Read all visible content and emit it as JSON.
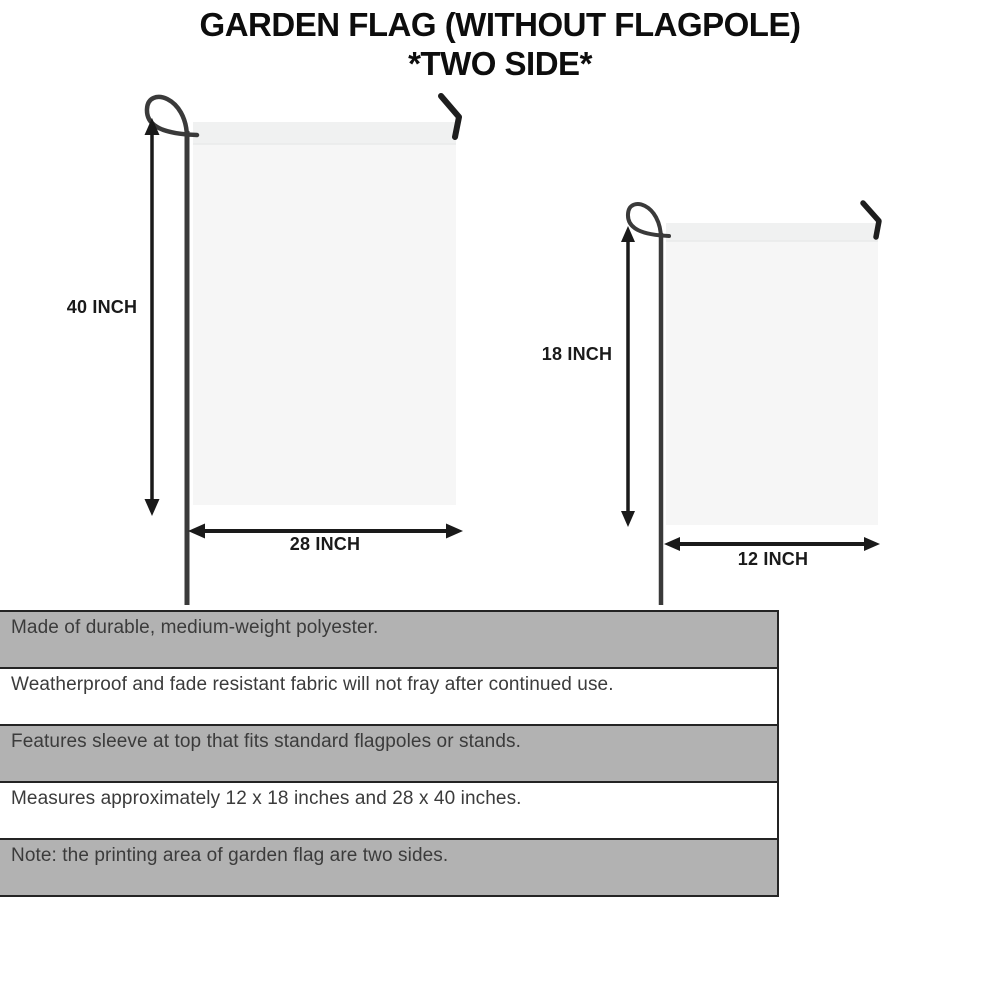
{
  "title": {
    "line1": "GARDEN FLAG (WITHOUT FLAGPOLE)",
    "line2": "*TWO SIDE*"
  },
  "diagram": {
    "large_flag": {
      "height_label": "40 INCH",
      "width_label": "28 INCH"
    },
    "small_flag": {
      "height_label": "18 INCH",
      "width_label": "12 INCH"
    }
  },
  "features": [
    {
      "text": "Made of durable, medium-weight polyester."
    },
    {
      "text": "Weatherproof and fade resistant fabric will not fray after continued use."
    },
    {
      "text": "Features sleeve at top that fits standard flagpoles or stands."
    },
    {
      "text": "Measures approximately 12 x 18 inches and 28 x 40 inches."
    },
    {
      "text": "Note: the printing area of garden flag are two sides."
    }
  ],
  "colors": {
    "stripe_gray": "#b2b2b2",
    "stripe_border": "#242424",
    "flag_fill": "#f6f6f6",
    "flag_sleeve": "#f0f1f1",
    "pole": "#3a3a3a",
    "arrow": "#1a1a1a",
    "title_text": "#0d0d0d",
    "feature_text": "#3b3b3b"
  }
}
